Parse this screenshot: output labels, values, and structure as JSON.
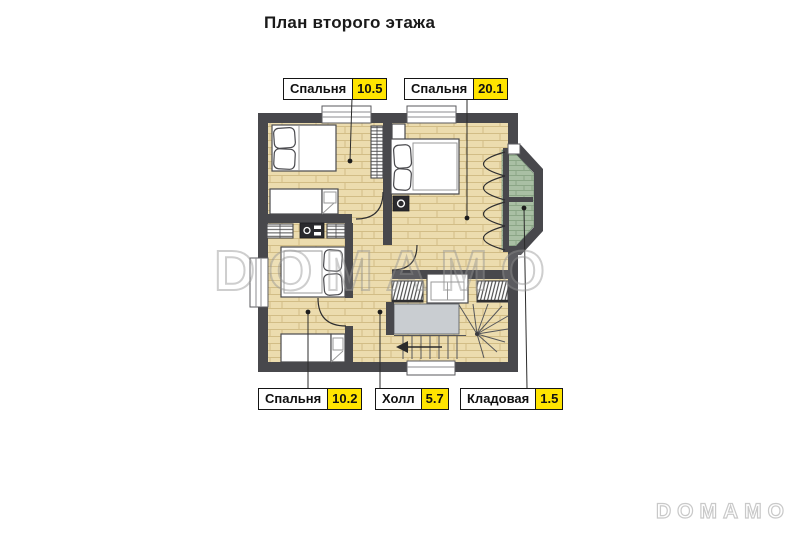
{
  "title": "План второго этажа",
  "rooms": [
    {
      "name": "Спальня",
      "area": "10.5"
    },
    {
      "name": "Спальня",
      "area": "20.1"
    },
    {
      "name": "Спальня",
      "area": "10.2"
    },
    {
      "name": "Холл",
      "area": "5.7"
    },
    {
      "name": "Кладовая",
      "area": "1.5"
    }
  ],
  "watermark": {
    "large": "DOMAMO",
    "small": "DOMAMO"
  },
  "colors": {
    "wall": "#48484c",
    "floor": "#ecdcae",
    "floor-line": "#d2bd86",
    "closet-floor": "#a9bfa4",
    "landing": "#c9cdd1",
    "area-highlight": "#ffe400",
    "label-border": "#151515"
  }
}
